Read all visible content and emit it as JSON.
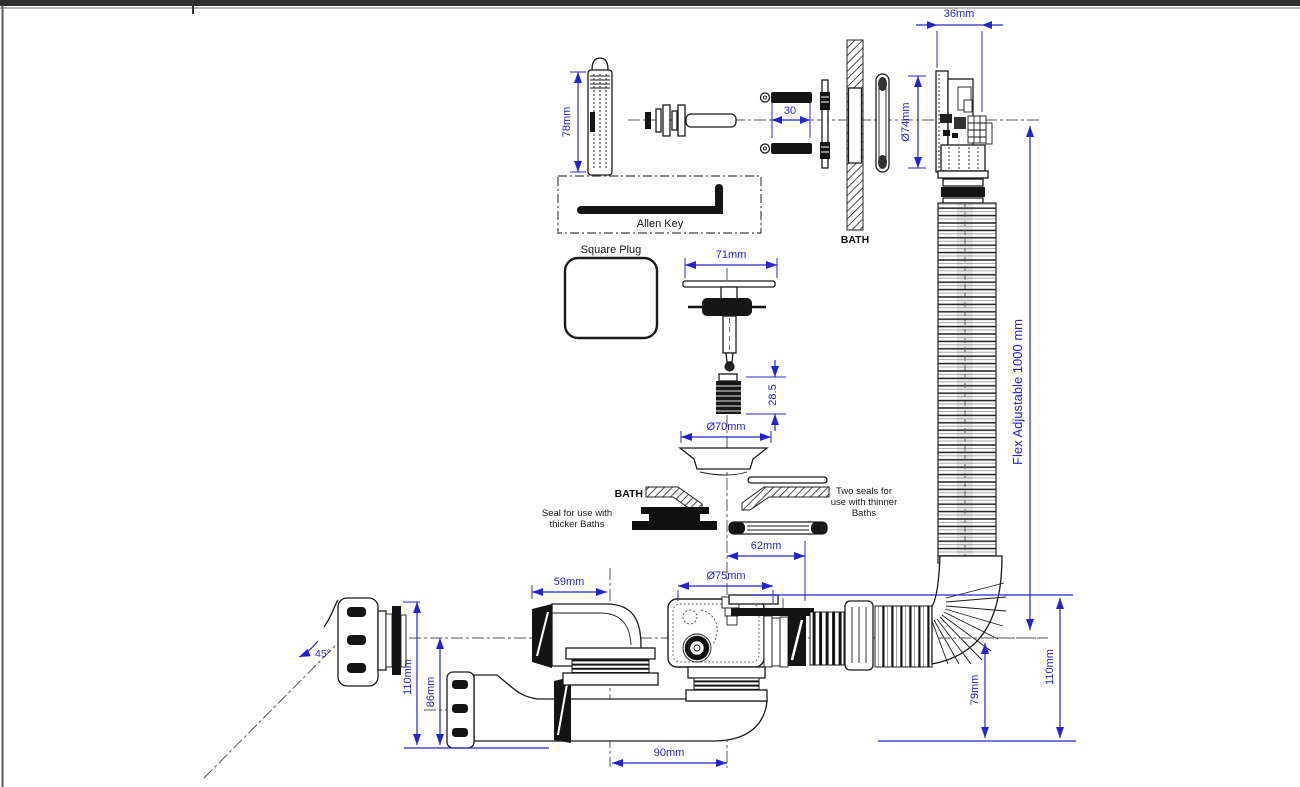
{
  "labels": {
    "allen_key": "Allen Key",
    "square_plug": "Square Plug",
    "bath_wall": "BATH",
    "bath_section": "BATH",
    "seal_thicker_line1": "Seal for use with",
    "seal_thicker_line2": "thicker Baths",
    "seal_thinner_line1": "Two seals for",
    "seal_thinner_line2": "use with thinner",
    "seal_thinner_line3": "Baths",
    "flex_adjustable": "Flex Adjustable  1000 mm"
  },
  "dims": {
    "d78": "78mm",
    "d30": "30",
    "d36": "36mm",
    "d74": "Ø74mm",
    "d71": "71mm",
    "d28_5": "28.5",
    "d70": "Ø70mm",
    "d62": "62mm",
    "d59": "59mm",
    "d75": "Ø75mm",
    "d52_upper": "52mm",
    "d52_lower": "52mm",
    "d40": "Ø40mm",
    "d50": "Ø50mm",
    "d45": "45°",
    "d110_left": "110mm",
    "d86": "86mm",
    "d90": "90mm",
    "d79": "79mm",
    "d110_right": "110mm"
  },
  "colors": {
    "dimension_blue": "#2424cc",
    "drawing_black": "#1a1a1a",
    "centerline_gray": "#555555"
  }
}
